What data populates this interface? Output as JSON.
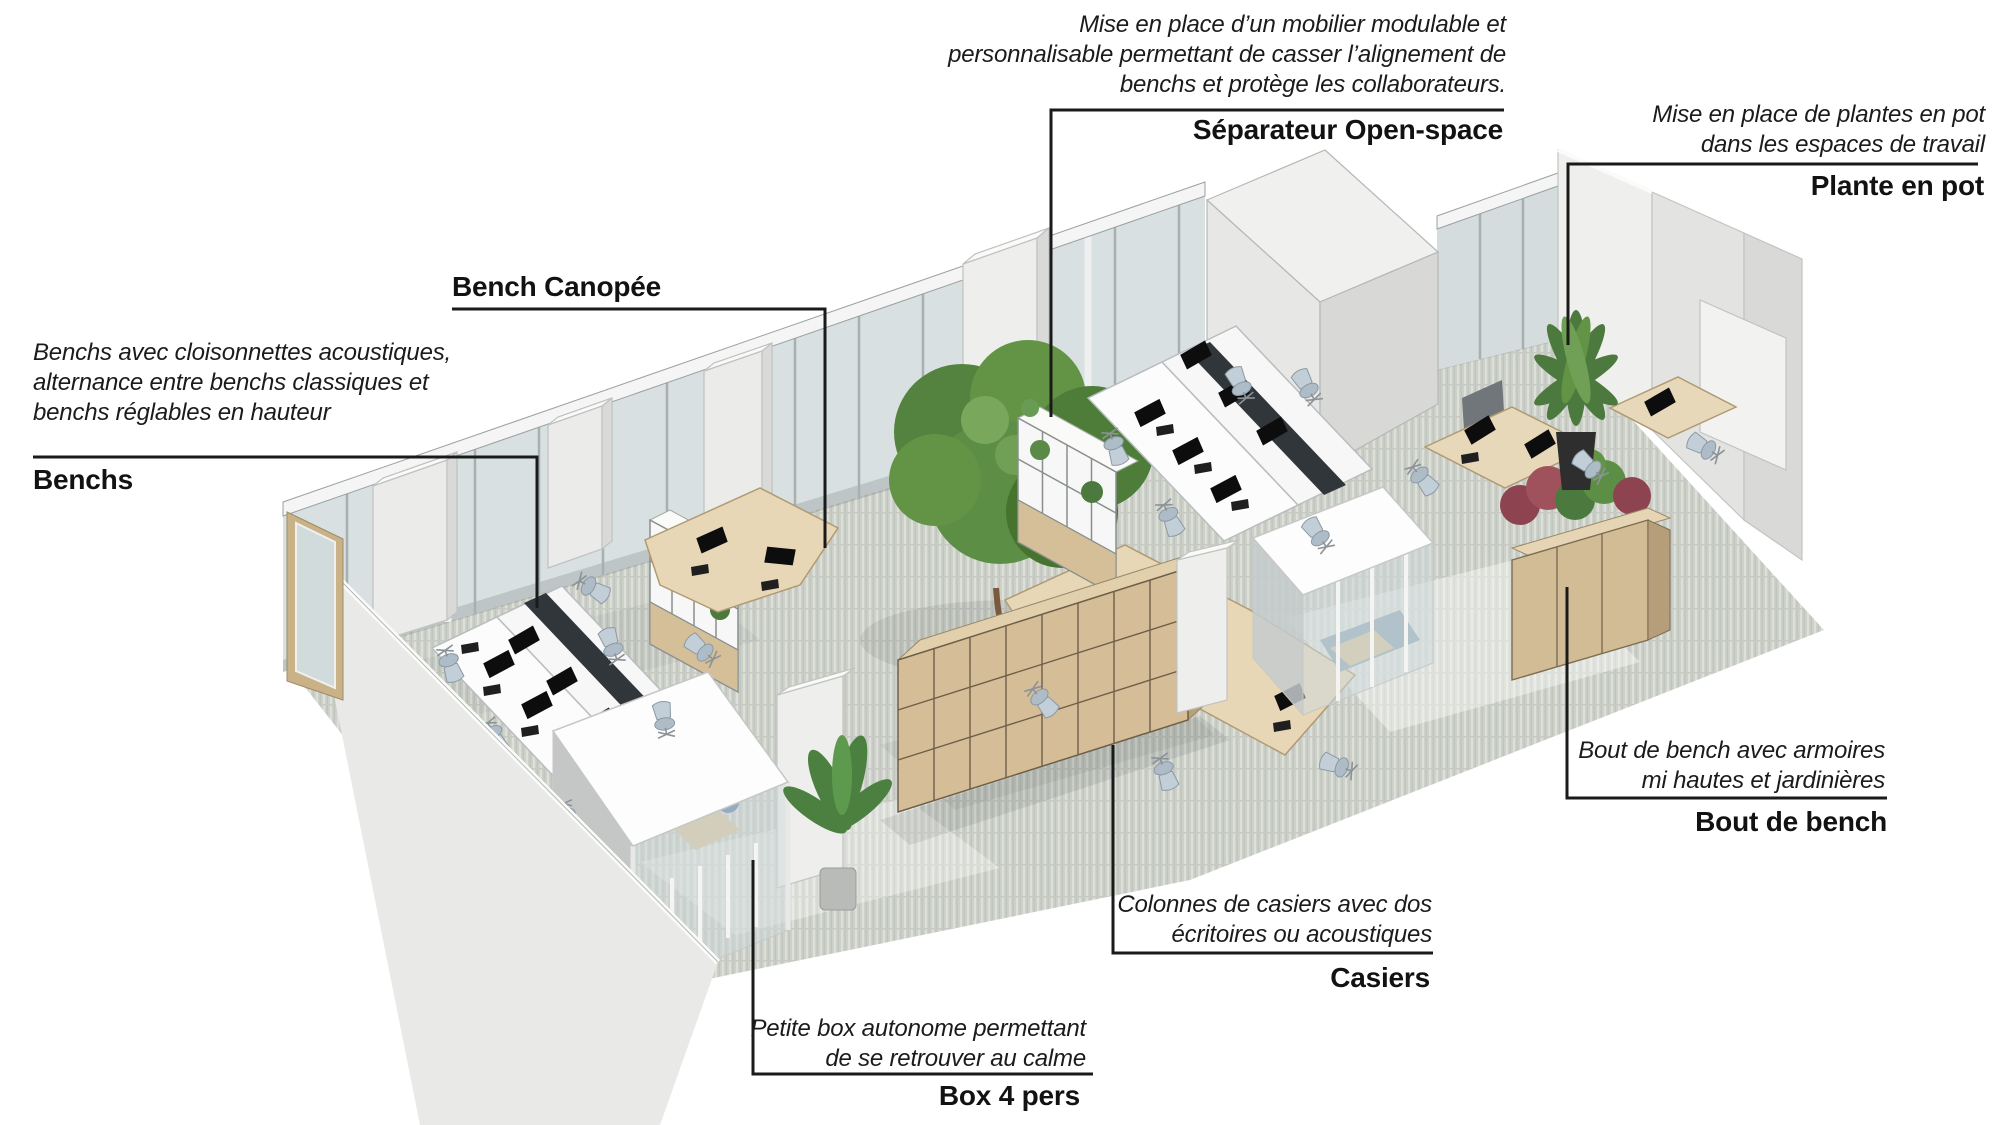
{
  "figure": {
    "type": "annotated 3d office floor rendering",
    "language": "fr"
  },
  "annotations": {
    "separateur_open_space": {
      "description": "Mise en place d’un mobilier modulable et\npersonnalisable permettant de casser l’alignement de\nbenchs et protège les collaborateurs.",
      "label": "Séparateur Open-space"
    },
    "plante_en_pot": {
      "description": "Mise en place de plantes en pot\ndans les espaces de travail",
      "label": "Plante en pot"
    },
    "bench_canopee": {
      "label": "Bench Canopée"
    },
    "benchs": {
      "description": "Benchs avec cloisonnettes acoustiques,\nalternance entre benchs classiques et\nbenchs réglables en hauteur",
      "label": "Benchs"
    },
    "bout_de_bench": {
      "description": "Bout de bench avec armoires\nmi hautes et jardinières",
      "label": "Bout de bench"
    },
    "casiers": {
      "description": "Colonnes de casiers avec dos\nécritoires ou acoustiques",
      "label": "Casiers"
    },
    "box_4_pers": {
      "description": "Petite box autonome permettant\nde se retrouver au calme",
      "label": "Box 4 pers"
    }
  },
  "palette": {
    "annotation_text": "#1b1b1b",
    "callout_line": "#1a1a1a",
    "carpet": "#ccd0c9",
    "glass": "#d7dfe1",
    "wood": "#d5bf99",
    "plant_green": "#4e7d3c",
    "white_furniture": "#f2f3f1"
  }
}
